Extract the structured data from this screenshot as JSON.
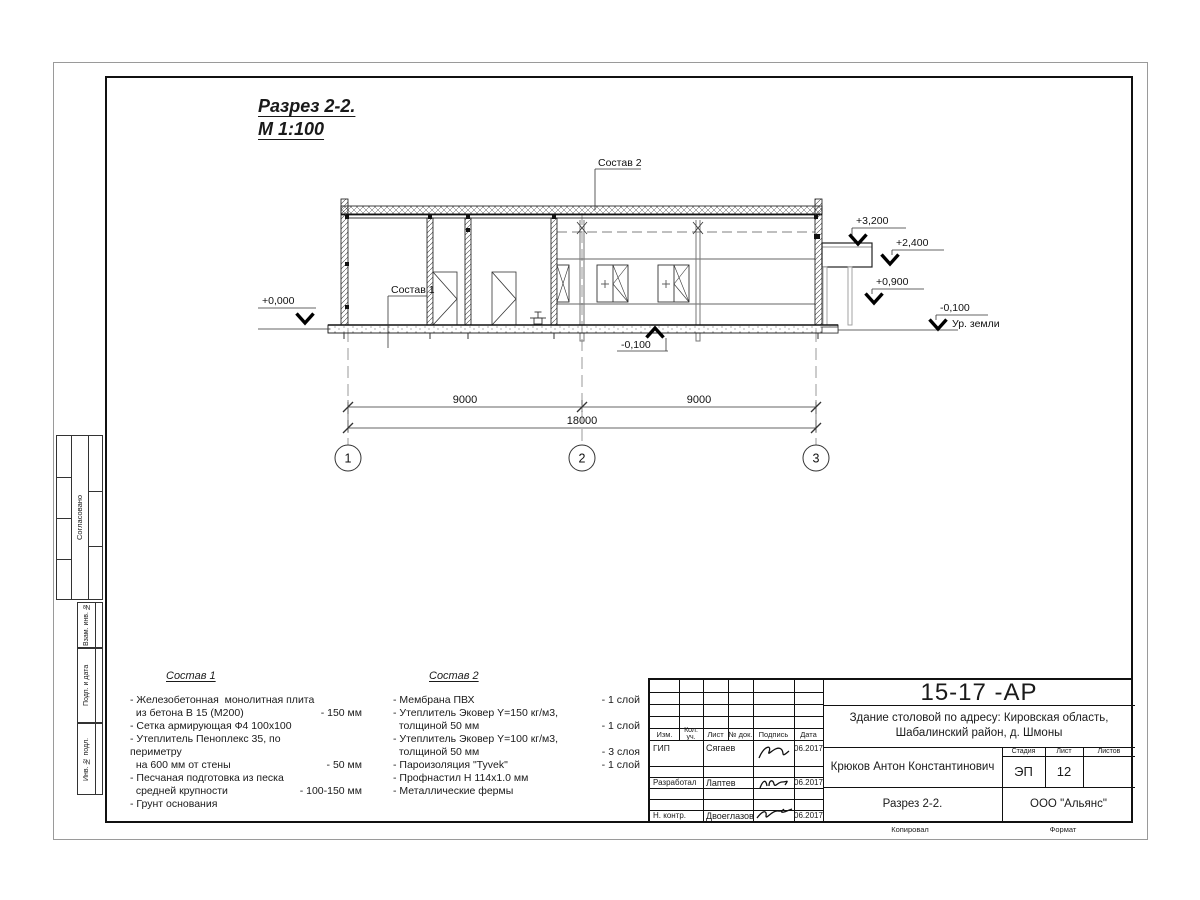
{
  "sheet": {
    "title_line1": "Разрез 2-2.",
    "title_line2": "М 1:100"
  },
  "drawing": {
    "callout_sostav1": "Состав 1",
    "callout_sostav2": "Состав 2",
    "elev_zero": "+0,000",
    "elev_3200": "+3,200",
    "elev_2400": "+2,400",
    "elev_0900": "+0,900",
    "elev_m0100_right": "-0,100",
    "elev_m0100_bottom": "-0,100",
    "ground_label": "Ур. земли",
    "dim_span1": "9000",
    "dim_span2": "9000",
    "dim_total": "18000",
    "axis_1": "1",
    "axis_2": "2",
    "axis_3": "3"
  },
  "materials1": {
    "title": "Состав 1",
    "items": [
      {
        "text": "- Железобетонная  монолитная плита\n  из бетона В 15 (М200)",
        "value": "- 150 мм"
      },
      {
        "text": "- Сетка армирующая Ф4 100х100",
        "value": ""
      },
      {
        "text": "- Утеплитель Пеноплекс 35, по периметру\n  на 600 мм от стены",
        "value": "- 50 мм"
      },
      {
        "text": "- Песчаная подготовка из песка\n  средней крупности",
        "value": "- 100-150 мм"
      },
      {
        "text": "- Грунт основания",
        "value": ""
      }
    ]
  },
  "materials2": {
    "title": "Состав 2",
    "items": [
      {
        "text": "- Мембрана ПВХ",
        "value": "- 1 слой"
      },
      {
        "text": "- Утеплитель Эковер Y=150 кг/м3,\n  толщиной 50 мм",
        "value": "- 1 слой"
      },
      {
        "text": "- Утеплитель Эковер Y=100 кг/м3,\n  толщиной 50 мм",
        "value": "- 3 слоя"
      },
      {
        "text": "- Пароизоляция \"Tyvek\"",
        "value": "- 1 слой"
      },
      {
        "text": "- Профнастил Н 114х1.0 мм",
        "value": ""
      },
      {
        "text": "- Металлические фермы",
        "value": ""
      }
    ]
  },
  "titleblock": {
    "doc_number": "15-17 -АР",
    "project_line1": "Здание столовой по адресу: Кировская область,",
    "project_line2": "Шабалинский район, д. Шмоны",
    "chief_name": "Крюков Антон Константинович",
    "drawing_name": "Разрез 2-2.",
    "company": "ООО \"Альянс\"",
    "stage_label": "Стадия",
    "sheet_label": "Лист",
    "sheets_label": "Листов",
    "stage_value": "ЭП",
    "sheet_value": "12",
    "col_izm": "Изм.",
    "col_kol": "Кол. уч.",
    "col_list": "Лист",
    "col_doc": "№ док.",
    "col_sign": "Подпись",
    "col_date": "Дата",
    "sig_rows": [
      {
        "role": "ГИП",
        "name": "Сягаев",
        "date": "06.2017"
      },
      {
        "role": "Разработал",
        "name": "Лаптев",
        "date": "06.2017"
      },
      {
        "role": "Н. контр.",
        "name": "Двоеглазов",
        "date": "06.2017"
      }
    ],
    "footer_copied": "Копировал",
    "footer_format": "Формат"
  },
  "margin_blocks": {
    "soglasovano": "Согласовано",
    "vzam": "Взам. инв. №",
    "podp": "Подп. и дата",
    "inv": "Инв. № подл."
  }
}
